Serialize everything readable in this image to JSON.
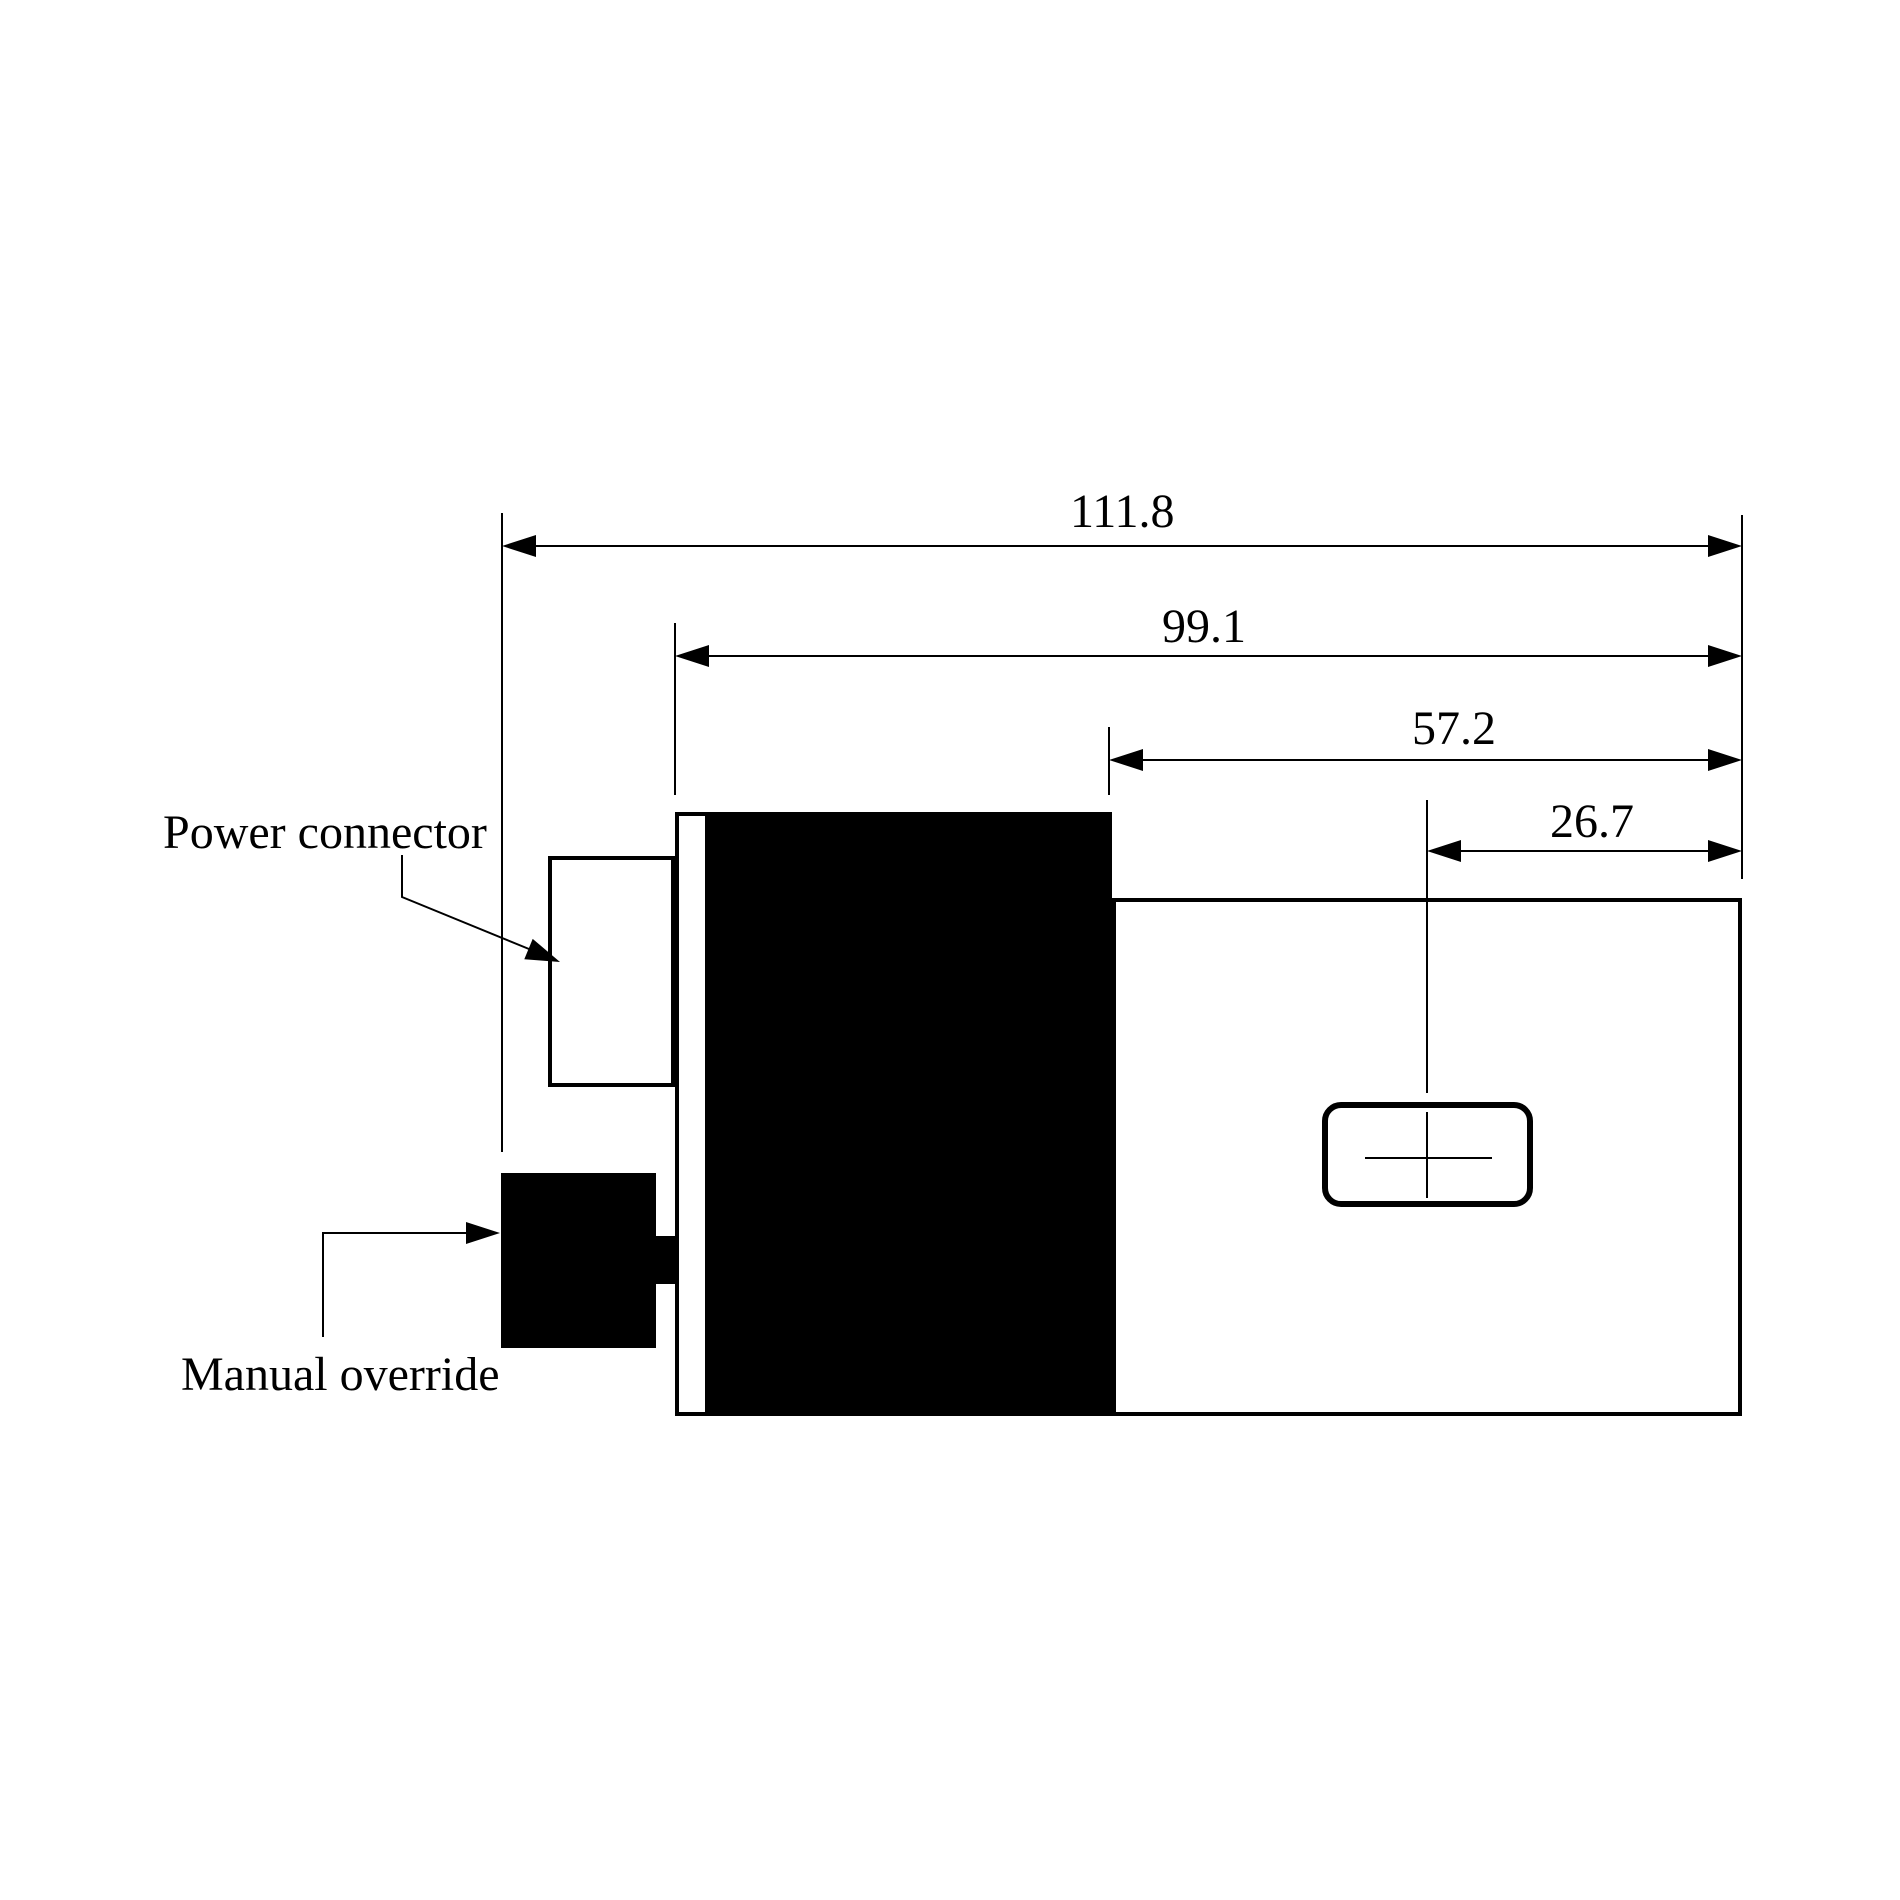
{
  "diagram": {
    "type": "technical-dimension-drawing",
    "view": "actuator-side-view",
    "background": "#ffffff",
    "stroke_color": "#000000",
    "dimensions": [
      {
        "id": "overall-length",
        "value": "111.8"
      },
      {
        "id": "body-length",
        "value": "99.1"
      },
      {
        "id": "housing-length",
        "value": "57.2"
      },
      {
        "id": "port-offset",
        "value": "26.7"
      }
    ],
    "callouts": [
      {
        "id": "power-connector",
        "label": "Power connector"
      },
      {
        "id": "manual-override",
        "label": "Manual override"
      }
    ]
  }
}
